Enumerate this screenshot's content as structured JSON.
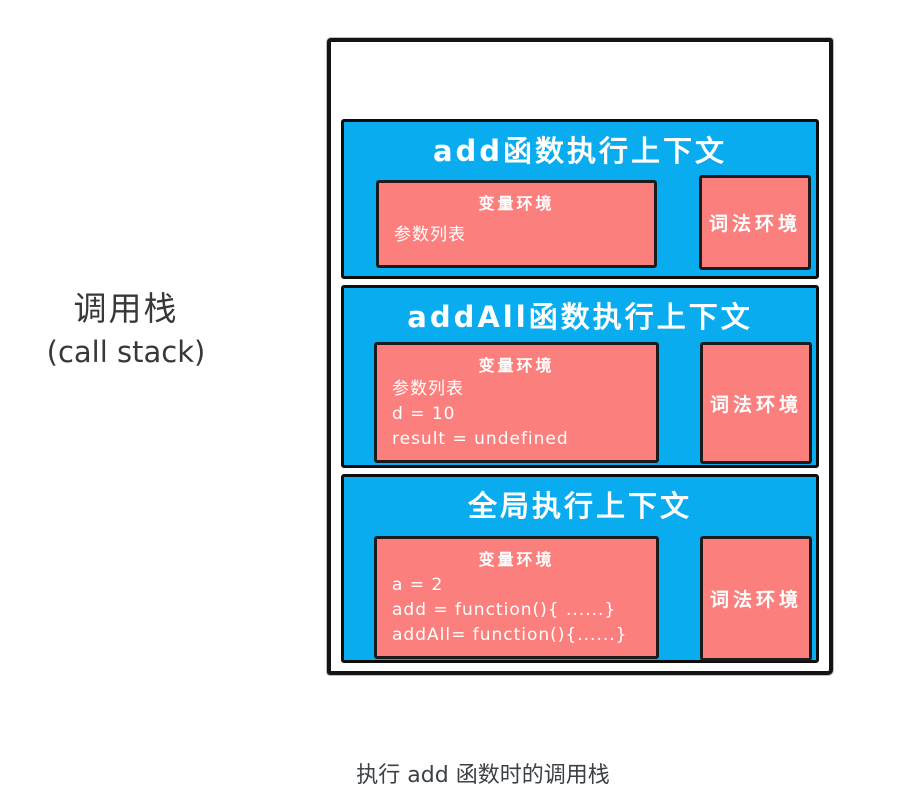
{
  "colors": {
    "frame_blue": "#0aacf0",
    "env_pink": "#fb7f7d",
    "ink": "#141414",
    "text_white": "#ffffff",
    "label_gray": "#383838"
  },
  "left_label": {
    "title_zh": "调用栈",
    "title_en": "(call stack)"
  },
  "caption": "执行 add 函数时的调用栈",
  "stack": {
    "frames": [
      {
        "id": "add",
        "title": "add函数执行上下文",
        "variable_env": {
          "label": "变量环境",
          "lines": [
            "参数列表"
          ]
        },
        "lexical_env": {
          "label": "词法环境"
        }
      },
      {
        "id": "addAll",
        "title": "addAll函数执行上下文",
        "variable_env": {
          "label": "变量环境",
          "lines": [
            "参数列表",
            "d = 10",
            "result = undefined"
          ]
        },
        "lexical_env": {
          "label": "词法环境"
        }
      },
      {
        "id": "global",
        "title": "全局执行上下文",
        "variable_env": {
          "label": "变量环境",
          "lines": [
            "a = 2",
            "add = function(){ ......}",
            "addAll= function(){......}"
          ]
        },
        "lexical_env": {
          "label": "词法环境"
        }
      }
    ]
  }
}
